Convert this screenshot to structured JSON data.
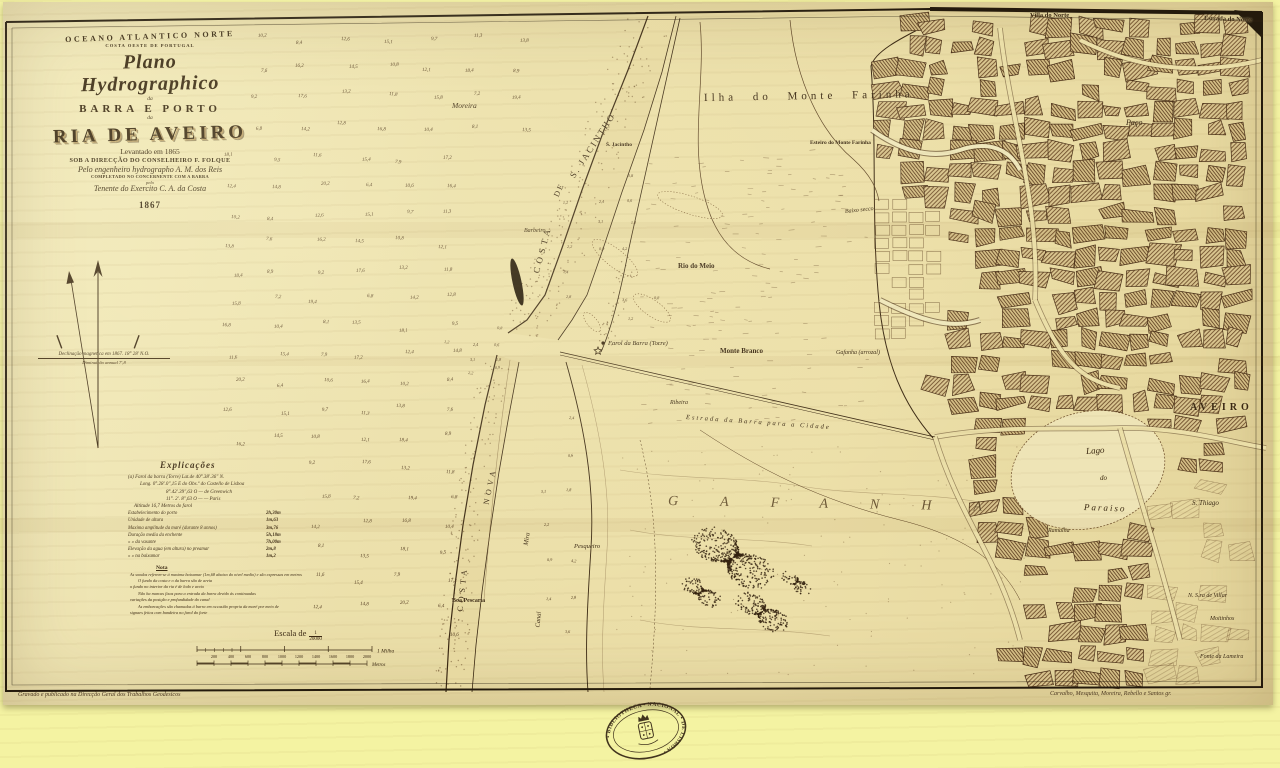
{
  "title_block": {
    "region": "OCEANO ATLANTICO NORTE",
    "region_sub": "COSTA OESTE DE PORTUGAL",
    "plan": "Plano Hydrographico",
    "of1": "da",
    "line_barra": "BARRA E PORTO",
    "of2": "da",
    "name": "RIA DE AVEIRO",
    "surveyed": "Levantado em 1865",
    "direction": "SOB A DIRECÇÃO DO CONSELHEIRO F. FOLQUE",
    "engineer": "Pelo engenheiro hydrographo A. M. dos Reis",
    "completed": "COMPLETADO NO CONCERNENTE COM A BARRA",
    "pelo": "pelo",
    "lieutenant": "Tenente do Exercito C. A. da Costa",
    "year": "1867"
  },
  "compass": {
    "declination1": "Declinação magnetica em 1867. 18° 28′ N.O.",
    "declination2": "Diminuição annual 7′,8"
  },
  "legend": {
    "heading": "Explicações",
    "position_lines": [
      "(a) Farol da barra (Torre)    Lat.de  40°.38′.36″ N.",
      "Long.  0°.28′.0″,15 E do Obs.º do Castello de Lisboa",
      "8°.42′.39″,63 O  —  de Greenwich",
      "11°. 2′. 8″,63 O  —  —  Paris",
      "Altitude 16,7 Metros do farol"
    ],
    "table": [
      {
        "label": "Estabelecimento do porto",
        "value": "2h,30m"
      },
      {
        "label": "Unidade de altura",
        "value": "1m,63"
      },
      {
        "label": "Maxima amplitude da maré (durante 8 annos)",
        "value": "3m,76"
      },
      {
        "label": "Duração media da enchente",
        "value": "5h,18m"
      },
      {
        "label": "   »        »     da vasante",
        "value": "7h,00m"
      },
      {
        "label": "Elevação da agua (em altura) no preamar",
        "value": "2m,8"
      },
      {
        "label": "   »        »        na baixamar",
        "value": "1m,2"
      }
    ],
    "nota_heading": "Nota",
    "nota_lines": [
      "As sondas referem-se á maxima baixamar (1m,68 abaixo do nivel medio) e são expressas em metros",
      "O fundo da costa e o da barra são de areia",
      "o fundo no interior da ria é de lodo e areia",
      "Não ha marcas fixas para a entrada da barra devido ás continuadas",
      "variações da posição e profundidade do canal",
      "As embarcações são chamadas á barra em occasião propria da maré por meio de",
      "signaes feitos com bandeira no farol do forte"
    ]
  },
  "scale": {
    "caption": "Escala de",
    "ratio_num": "1",
    "ratio_den": "20000",
    "mile_label": "1 Milha",
    "metric_ticks": [
      "200",
      "400",
      "600",
      "800",
      "1000",
      "1200",
      "1400",
      "1600",
      "1800",
      "2000"
    ],
    "metric_unit": "Metros"
  },
  "map_labels": [
    {
      "t": "Villa do Norte",
      "x": 1030,
      "y": 12,
      "s": 6.5,
      "r": 0,
      "c": "b"
    },
    {
      "t": "Estrada do Norte",
      "x": 1204,
      "y": 15,
      "s": 6.5,
      "r": 2,
      "c": "b"
    },
    {
      "t": "Ilha do Monte Farinha",
      "x": 704,
      "y": 92,
      "s": 11,
      "r": -1,
      "c": "sp2"
    },
    {
      "t": "Esteiro do Monte Farinha",
      "x": 810,
      "y": 140,
      "s": 5.5,
      "r": 0,
      "c": "b"
    },
    {
      "t": "Moreira",
      "x": 452,
      "y": 101,
      "s": 7.5,
      "r": 0,
      "c": "it"
    },
    {
      "t": "COSTA",
      "x": 536,
      "y": 268,
      "s": 9,
      "r": -75,
      "c": "sp2"
    },
    {
      "t": "DE",
      "x": 556,
      "y": 192,
      "s": 8,
      "r": -65,
      "c": "sp1"
    },
    {
      "t": "S. JACINTHO",
      "x": 572,
      "y": 172,
      "s": 9,
      "r": -57,
      "c": "sp1"
    },
    {
      "t": "S. Jacintho",
      "x": 606,
      "y": 142,
      "s": 5.5,
      "r": 0,
      "c": "b"
    },
    {
      "t": "Barbeiro",
      "x": 524,
      "y": 228,
      "s": 6,
      "r": 0,
      "c": "it"
    },
    {
      "t": "Rio do Meio",
      "x": 678,
      "y": 262,
      "s": 7,
      "r": 0,
      "c": "b"
    },
    {
      "t": "Baixo secco",
      "x": 845,
      "y": 209,
      "s": 6,
      "r": -6,
      "c": "it"
    },
    {
      "t": "Farol da Barra (Torre)",
      "x": 608,
      "y": 340,
      "s": 6.5,
      "r": 0,
      "c": "it"
    },
    {
      "t": "Monte Branco",
      "x": 720,
      "y": 347,
      "s": 7,
      "r": 0,
      "c": "b"
    },
    {
      "t": "Ribeira",
      "x": 670,
      "y": 400,
      "s": 6,
      "r": 0,
      "c": "it"
    },
    {
      "t": "Estrada da Barra para a Cidade",
      "x": 686,
      "y": 414,
      "s": 6.5,
      "r": 4,
      "c": "it sp1"
    },
    {
      "t": "Gafanha (arrozal)",
      "x": 836,
      "y": 350,
      "s": 6,
      "r": 0,
      "c": "it"
    },
    {
      "t": "GAFANHA",
      "x": 668,
      "y": 494,
      "s": 14,
      "r": 1,
      "c": "it spread"
    },
    {
      "t": "Lago",
      "x": 1086,
      "y": 446,
      "s": 9,
      "r": -4,
      "c": "it"
    },
    {
      "t": "do",
      "x": 1100,
      "y": 474,
      "s": 7,
      "r": 0,
      "c": "it"
    },
    {
      "t": "Paraiso",
      "x": 1084,
      "y": 502,
      "s": 9,
      "r": 2,
      "c": "it sp1"
    },
    {
      "t": "S. Thiago",
      "x": 1192,
      "y": 499,
      "s": 7,
      "r": 0,
      "c": "it"
    },
    {
      "t": "AVEIRO",
      "x": 1190,
      "y": 402,
      "s": 10,
      "r": 0,
      "c": "b sp2"
    },
    {
      "t": "Paço",
      "x": 1126,
      "y": 118,
      "s": 8,
      "r": 0,
      "c": "it"
    },
    {
      "t": "NOVA",
      "x": 486,
      "y": 500,
      "s": 8,
      "r": -78,
      "c": "sp2"
    },
    {
      "t": "COSTA",
      "x": 460,
      "y": 607,
      "s": 8,
      "r": -84,
      "c": "sp2"
    },
    {
      "t": "Boa Pescaria",
      "x": 452,
      "y": 598,
      "s": 6,
      "r": 0,
      "c": "b"
    },
    {
      "t": "Mira",
      "x": 526,
      "y": 542,
      "s": 6.5,
      "r": -80,
      "c": "it"
    },
    {
      "t": "Canal",
      "x": 538,
      "y": 624,
      "s": 6.5,
      "r": -85,
      "c": "it"
    },
    {
      "t": "Pesqueiro",
      "x": 574,
      "y": 543,
      "s": 6.5,
      "r": 0,
      "c": "it"
    },
    {
      "t": "Ramalha",
      "x": 1048,
      "y": 528,
      "s": 6,
      "r": 0,
      "c": "it"
    },
    {
      "t": "N. S.ra de Villar",
      "x": 1188,
      "y": 593,
      "s": 6,
      "r": 0,
      "c": "it"
    },
    {
      "t": "Moitinhos",
      "x": 1210,
      "y": 616,
      "s": 6,
      "r": 0,
      "c": "it"
    },
    {
      "t": "Fonte da Lameira",
      "x": 1200,
      "y": 654,
      "s": 6,
      "r": 0,
      "c": "it"
    }
  ],
  "soundings": {
    "values": [
      "10,2",
      "8,4",
      "12,6",
      "15,1",
      "9,7",
      "11,3",
      "13,8",
      "7,6",
      "16,2",
      "14,5",
      "10,8",
      "12,1",
      "18,4",
      "8,9",
      "9,2",
      "17,6",
      "13,2",
      "11,8",
      "15,8",
      "7,2",
      "19,4",
      "6,8",
      "14,2",
      "12,8",
      "16,8",
      "10,4",
      "8,1",
      "13,5",
      "18,1",
      "9,5",
      "11,6",
      "15,4",
      "7,9",
      "17,2",
      "12,4",
      "14,8",
      "20,2",
      "6,4",
      "10,6",
      "16,4"
    ],
    "shallow_values": [
      "0,8",
      "1,2",
      "2,4",
      "0,6",
      "3,1",
      "1,8",
      "2,2",
      "0,9",
      "4,2",
      "1,4",
      "2,8",
      "3,6"
    ]
  },
  "seal": {
    "text": "• BIBLIOTHECA • NACIONAL • DE LISBOA •"
  },
  "credits": {
    "left": "Gravado e publicado na Direcção Geral dos Trabalhos Geodesicos",
    "right": "Carvalho, Mesquita, Moreira, Rebello e Santos gr."
  },
  "colors": {
    "paper": "#ebdfa9",
    "outer_margin": "#f4f3a2",
    "ink": "#3a2812",
    "sand": "#e7d9a1",
    "city_hatch": "#6b4a28",
    "pond": "#241806"
  }
}
